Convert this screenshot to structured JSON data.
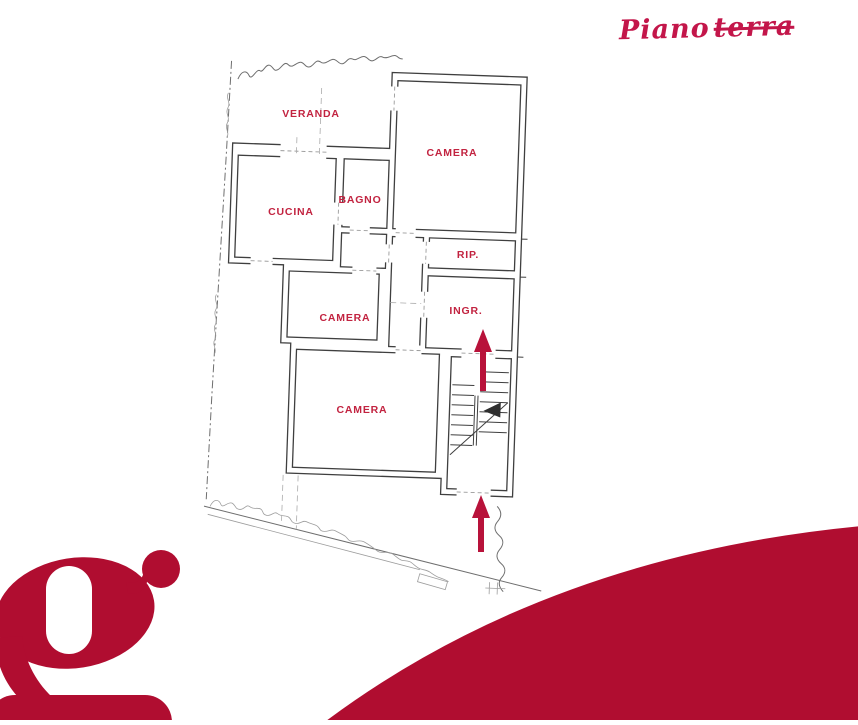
{
  "header": {
    "title": {
      "word1": "Piano",
      "word2": "terra"
    }
  },
  "colors": {
    "brand_red": "#b00d30",
    "title_red": "#c3164a",
    "label_red": "#c22340",
    "arrow_red": "#b8123a",
    "plan_line": "#3f3f3f",
    "sketch_line": "#6e6e6e"
  },
  "floor_plan": {
    "rooms": [
      {
        "id": "veranda",
        "label": "VERANDA"
      },
      {
        "id": "camera-nord",
        "label": "CAMERA"
      },
      {
        "id": "cucina",
        "label": "CUCINA"
      },
      {
        "id": "bagno",
        "label": "BAGNO"
      },
      {
        "id": "ripostiglio",
        "label": "RIP."
      },
      {
        "id": "ingresso",
        "label": "INGR."
      },
      {
        "id": "camera-centro",
        "label": "CAMERA"
      },
      {
        "id": "camera-sud",
        "label": "CAMERA"
      }
    ],
    "features": {
      "staircase": true,
      "entrance_arrows": 2,
      "arrow_direction": "up"
    }
  },
  "logo": {
    "letter": "g"
  }
}
